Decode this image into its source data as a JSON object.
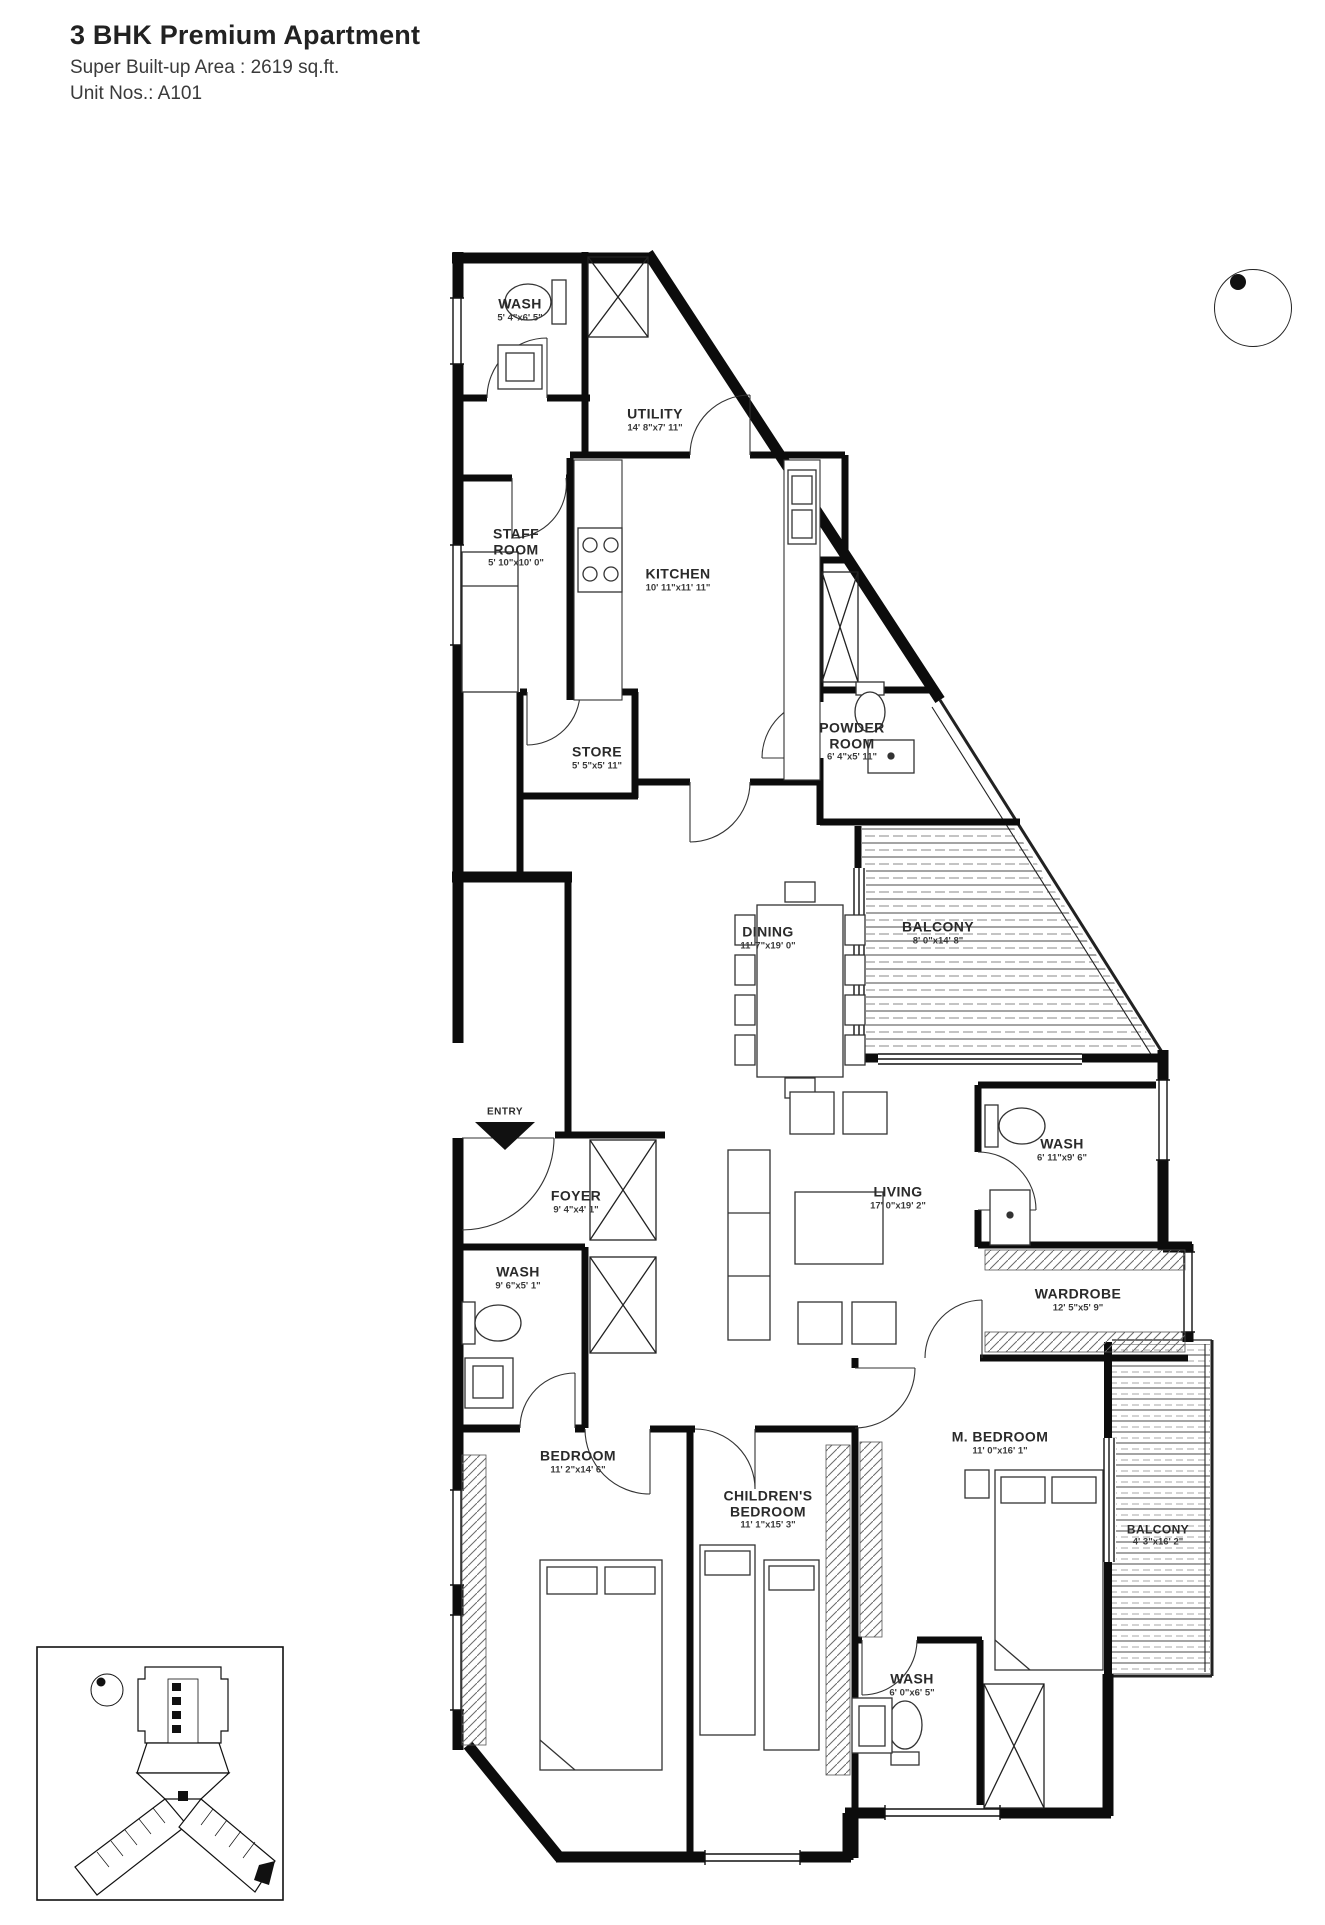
{
  "header": {
    "title": "3 BHK Premium Apartment",
    "area": "Super Built-up Area : 2619 sq.ft.",
    "unit": "Unit Nos.: A101"
  },
  "entry_label": "ENTRY",
  "icons": {
    "compass": "north-indicator",
    "entry_arrow": "entry-direction-arrow"
  },
  "rooms": [
    {
      "name": "WASH",
      "dims": "5' 4\"x6' 5\""
    },
    {
      "name": "UTILITY",
      "dims": "14' 8\"x7' 11\""
    },
    {
      "name": "STAFF ROOM",
      "dims": "5' 10\"x10' 0\""
    },
    {
      "name": "KITCHEN",
      "dims": "10' 11\"x11' 11\""
    },
    {
      "name": "STORE",
      "dims": "5' 5\"x5' 11\""
    },
    {
      "name": "POWDER ROOM",
      "dims": "6' 4\"x5' 11\""
    },
    {
      "name": "DINING",
      "dims": "11' 7\"x19' 0\""
    },
    {
      "name": "BALCONY",
      "dims": "8' 0\"x14' 8\""
    },
    {
      "name": "FOYER",
      "dims": "9' 4\"x4' 1\""
    },
    {
      "name": "LIVING",
      "dims": "17' 0\"x19' 2\""
    },
    {
      "name": "WASH",
      "dims": "6' 11\"x9' 6\""
    },
    {
      "name": "WARDROBE",
      "dims": "12' 5\"x5' 9\""
    },
    {
      "name": "WASH",
      "dims": "9' 6\"x5' 1\""
    },
    {
      "name": "BEDROOM",
      "dims": "11' 2\"x14' 6\""
    },
    {
      "name": "CHILDREN'S BEDROOM",
      "dims": "11' 1\"x15' 3\""
    },
    {
      "name": "M. BEDROOM",
      "dims": "11' 0\"x16' 1\""
    },
    {
      "name": "BALCONY",
      "dims": "4' 3\"x16' 2\""
    },
    {
      "name": "WASH",
      "dims": "6' 0\"x6' 5\""
    }
  ]
}
